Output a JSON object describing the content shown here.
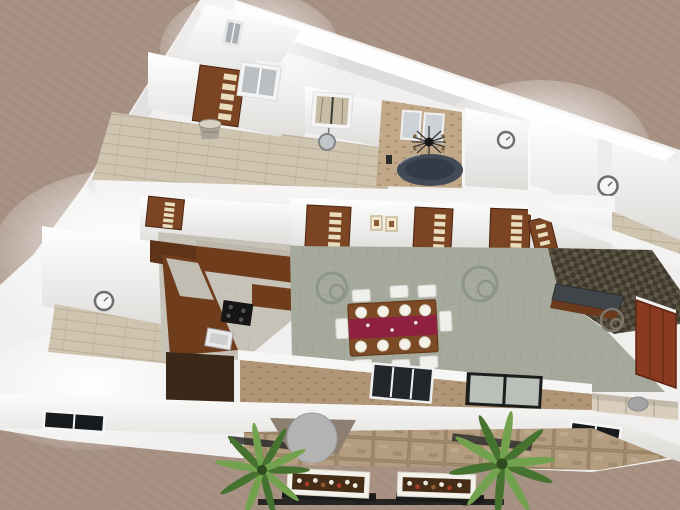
{
  "app": {
    "name": "3d-floor-plan-render",
    "view": "aerial cutaway perspective of a single-story house"
  },
  "colors": {
    "wallpaper": "#a79183",
    "wall": "#f0efed",
    "wall_shade": "#d9d7d4",
    "wood_floor": "#cfc4b0",
    "living_floor": "#a6aa9d",
    "office_floor": "#57503f",
    "travertine": "#c0a888",
    "stone_wall": "#b09676",
    "patio": "#b49d7f",
    "marble": "#c7c3b8",
    "cabinet": "#6f3d1c",
    "counter": "#bcb6ab",
    "door": "#7b4423",
    "door_pane": "#e9ddbe",
    "cooktop": "#161616",
    "sink": "#e9e9e9",
    "tub": "#424a57",
    "tub_inner": "#343b46",
    "runner": "#8e2140",
    "table": "#7c4a24",
    "plate": "#f5f2ea",
    "chair": "#efefec",
    "sofa": "#d9cebc",
    "armchair": "#a3a3a3",
    "wardrobe": "#8a3a20",
    "desk_top": "#40454a",
    "desk_base": "#6b3a1d",
    "glass_dark": "#181b1e",
    "glass_light": "#c7cdc7",
    "curtain": "#c8bca4",
    "clock": "#6e6e6e",
    "ring_light": "#8f948c",
    "palm_dark": "#46722f",
    "palm_light": "#73a24e",
    "umbrella": "#b3b3b3",
    "awning": "#8d7e72",
    "fence": "#222222",
    "planter_box": "#f3f1ea",
    "planter_soil": "#452c16",
    "closet_floor": "#3a2718",
    "dark_window": "#23262a"
  },
  "scene": {
    "background": "plain taupe textured wallpaper",
    "rooms": [
      {
        "name": "apex-entry",
        "items": [
          "small-window",
          "framed-mirror"
        ]
      },
      {
        "name": "bedroom-top-left",
        "floor": "light wood",
        "items": [
          "five-pane-wood-door",
          "window",
          "barrel-planter"
        ]
      },
      {
        "name": "bedroom-top-middle",
        "floor": "light wood",
        "items": [
          "curtained-window",
          "round-wall-ornament"
        ]
      },
      {
        "name": "bathroom",
        "floor": "travertine",
        "items": [
          "twin-mirrors",
          "sunburst-wall-clock",
          "round-spa-tub"
        ]
      },
      {
        "name": "hallway",
        "items": [
          "wall-clock"
        ]
      },
      {
        "name": "bedroom-top-right",
        "floor": "light wood",
        "items": [
          "wall-clock"
        ]
      },
      {
        "name": "bedroom-mid-left",
        "floor": "light wood",
        "items": [
          "wall-clock"
        ]
      },
      {
        "name": "kitchen",
        "floor": "marble",
        "items": [
          "u-shaped-wood-cabinets",
          "gray-counter",
          "black-cooktop",
          "white-sink",
          "dark-closet-floor"
        ]
      },
      {
        "name": "living-dining",
        "floor": "sage tile",
        "items": [
          "dining-table",
          "red-table-runner",
          "place-settings",
          "white-chairs",
          "ceiling-light",
          "ceiling-light",
          "five-pane-wood-doors",
          "two-wall-pictures"
        ]
      },
      {
        "name": "office",
        "floor": "dark patterned tile",
        "items": [
          "desk",
          "ceiling-light",
          "red-wardrobe",
          "beige-sectional-sofa",
          "gray-armchair"
        ]
      }
    ],
    "exterior": {
      "south_wall": [
        "stone-cladding",
        "dark-window",
        "sliding-glass-door"
      ],
      "yard": [
        "stone-patio",
        "patio-umbrella-table",
        "flower-planter-box",
        "flower-planter-box",
        "palm-plant",
        "palm-plant",
        "dark-garden-fence"
      ]
    },
    "counts": {
      "plates": 8,
      "dining_chairs": 6,
      "panel_doors": 7,
      "wall_clocks": 3,
      "mirrors": 2,
      "planter_boxes": 2,
      "palms": 2,
      "ceiling_lights": 3,
      "wall_pictures": 2
    }
  }
}
